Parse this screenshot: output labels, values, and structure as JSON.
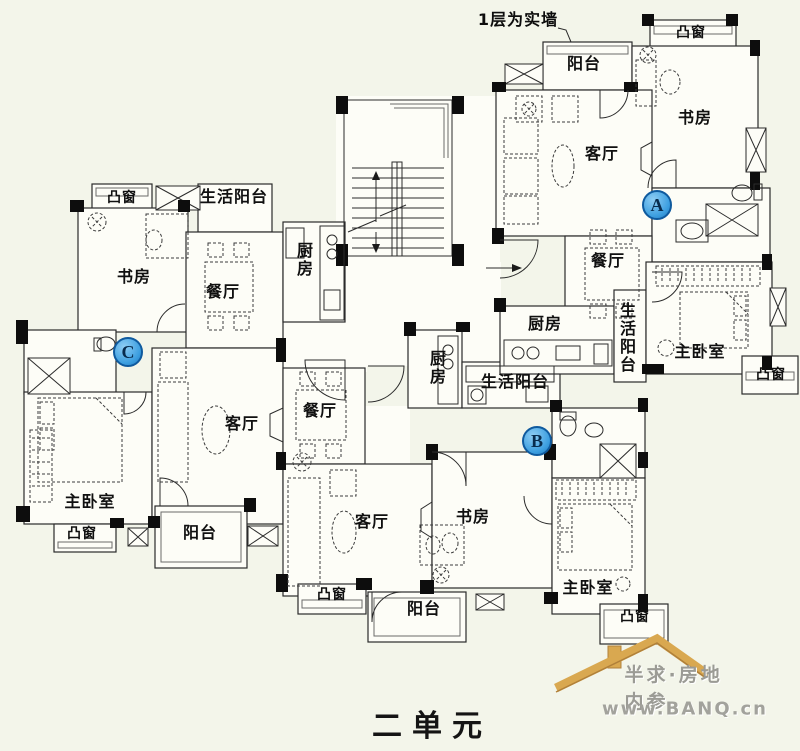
{
  "plan": {
    "note_top": "1层为实墙",
    "bottom_title": "二单元"
  },
  "units": [
    {
      "marker": "A",
      "rooms": {
        "bay_window_top": "凸窗",
        "balcony": "阳台",
        "study": "书房",
        "living_room": "客厅",
        "dining_room": "餐厅",
        "kitchen": "厨房",
        "utility_balcony": "生活阳台",
        "master_bedroom": "主卧室",
        "bay_window_side": "凸窗"
      }
    },
    {
      "marker": "B",
      "rooms": {
        "dining_room": "餐厅",
        "kitchen": "厨房",
        "utility_balcony": "生活阳台",
        "living_room": "客厅",
        "study": "书房",
        "master_bedroom": "主卧室",
        "bay_window_left": "凸窗",
        "balcony": "阳台",
        "bay_window_right": "凸窗"
      }
    },
    {
      "marker": "C",
      "rooms": {
        "bay_window_top": "凸窗",
        "utility_balcony": "生活阳台",
        "study": "书房",
        "dining_room": "餐厅",
        "kitchen": "厨房",
        "living_room": "客厅",
        "master_bedroom": "主卧室",
        "bay_window_bottom": "凸窗",
        "balcony": "阳台"
      }
    }
  ],
  "logo": {
    "brand": "半求·房地内参",
    "url": "www.BANQ.cn"
  },
  "colors": {
    "background": "#f3f5ea",
    "room_fill": "#fdfdf7",
    "wall": "#2b2b2b",
    "pier": "#0d0d0d",
    "marker_fill": "#3d9fe0",
    "marker_border": "#0f5a9e",
    "logo_roof": "#d9a850",
    "logo_text": "#9b9b95"
  }
}
